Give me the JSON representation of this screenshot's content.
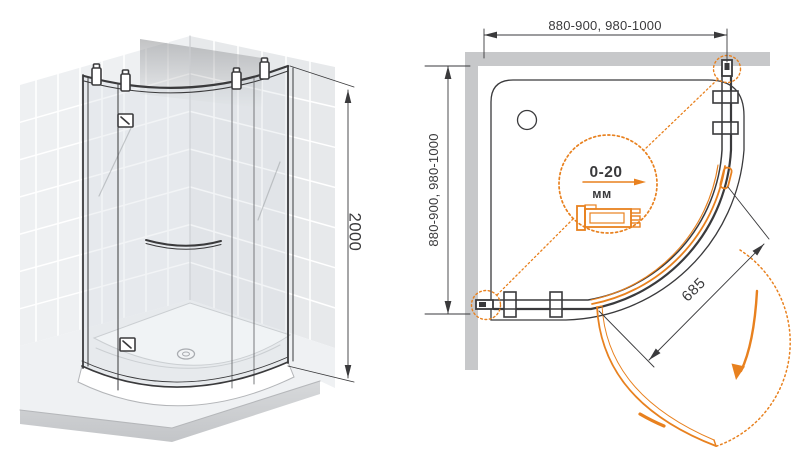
{
  "colors": {
    "line": "#3a3a3c",
    "accent_orange": "#e8811f",
    "wall_gray": "#c7c8ca",
    "tile_gray": "#eef0f2"
  },
  "perspective_view": {
    "height_dimension_label": "2000"
  },
  "plan_view": {
    "top_width_dimension_label": "880-900, 980-1000",
    "left_depth_dimension_label": "880-900, 980-1000",
    "door_opening_dimension_label": "685",
    "adjustment_callout": {
      "range_label": "0-20",
      "unit_label": "мм"
    }
  }
}
